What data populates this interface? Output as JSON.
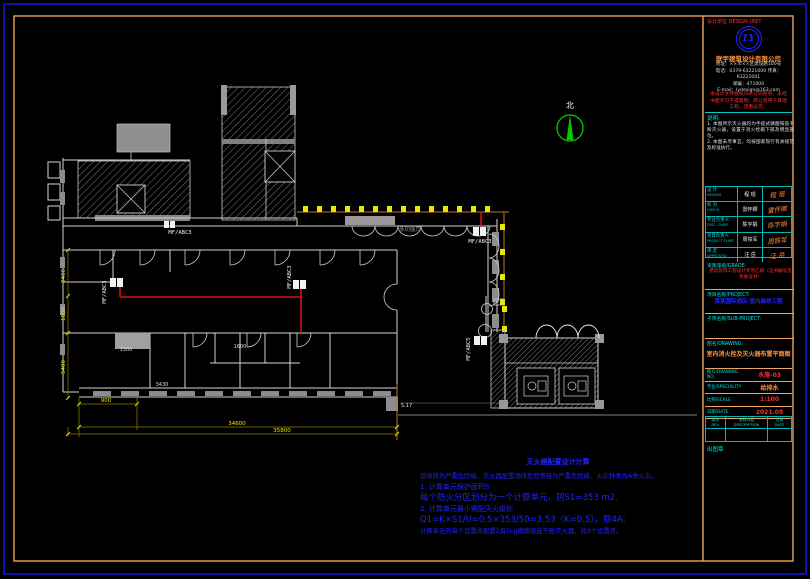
{
  "canvas": {
    "width": 810,
    "height": 579
  },
  "colors": {
    "border_blue": "#1515d8",
    "border_orange": "#eda45f",
    "wall_gray": "#d4d4d4",
    "fill_gray": "#8c8c8c",
    "pipe_red": "#ff1212",
    "axis_orange": "#c07818",
    "dim_yellow": "#e6e600",
    "cyan": "#00e0e0",
    "calc_blue": "#2222ff",
    "north_green": "#00cc00"
  },
  "plan": {
    "north_label": "北",
    "room_label": "多功能厅",
    "extinguishers": [
      {
        "label": "MF/ABC3"
      },
      {
        "label": "MF/ABC3"
      },
      {
        "label": "MF/ABC3"
      },
      {
        "label": "MF/ABC5"
      },
      {
        "label": "MF/ABC3"
      }
    ],
    "dims": {
      "bottom_small": "900",
      "bottom_mid": "34600",
      "bottom_total": "35800",
      "inner_a": "3430",
      "inner_b": "1500",
      "inner_c": "1600",
      "level": "5.17",
      "left_a": "2400",
      "left_b": "1800",
      "left_c": "5400"
    }
  },
  "calc": {
    "title": "灭火器配置设计计算",
    "lines": [
      "该场所为严重危险级，灭火器配置场所危险等级为严重危险级，火灾种类为A类火灾。",
      "1. 计算单元保护面积S",
      "每个防火分区划分为一个计算单元，则S1=353 m2.",
      "2. 计算单元最小需配灭火级别",
      "Q1=K×S1/U=0.5×353/50=3.53（K=0.5），取4A;",
      "计算单元内每个设置点配置2具5kg磷酸铵盐干粉灭火器，共3个设置点。"
    ]
  },
  "title_block": {
    "design_unit_label": "设计单位 DESIGN UNIT",
    "logo_text": "LY",
    "company": "联宇建筑设计有限公司",
    "address_lines": [
      "地址：××市××区建设路100号",
      "电话：0379-63221000 传真：63221001",
      "邮编：471000",
      "E-mail：lydesign@163.com"
    ],
    "copyright_lines": [
      "本设计文件版权归本公司所有，未经",
      "书面许可不得复制、转让或用于其他",
      "工程，违者必究。"
    ],
    "notes_label": "说明:",
    "notes": [
      "1. 本图所示灭火器均为手提式磷酸铵盐干粉灭火器，设置于消火栓箱下部及明显部位。",
      "2. 本图未尽事宜，均按国家现行有关规范及标准执行。"
    ],
    "staff_rows": [
      {
        "role": "设 计",
        "role_en": "DESIGN",
        "name": "程 琨",
        "signature": "程 琨"
      },
      {
        "role": "校 对",
        "role_en": "CHECK",
        "name": "雷怀卿",
        "signature": "雷怀卿"
      },
      {
        "role": "专业负责人",
        "role_en": "DISC. CHIEF",
        "name": "陈宇娟",
        "signature": "陈宇娟"
      },
      {
        "role": "项目负责人",
        "role_en": "PROJECT CHIEF",
        "name": "周铁军",
        "signature": "周铁军"
      },
      {
        "role": "审 定",
        "role_en": "APPROVED",
        "name": "汪 岳",
        "signature": "汪 岳"
      }
    ],
    "grade_label": "资质等级/GRADE:",
    "grade_value": "建筑装饰工程设计专项乙级（证书编号见资质证书）",
    "project_label": "项目名称/PROJECT:",
    "project_name": "某某国际酒店·室内装修工程",
    "subproject_label": "子项名称/SUB-PROJECT:",
    "drawing_label": "图名/DRAWING:",
    "drawing_title": "室内消火栓及灭火器布置平面图",
    "fields": [
      {
        "label": "图号/DRAWING NO.",
        "value": "水施-03"
      },
      {
        "label": "专业/SPECIALITY",
        "value": "给排水"
      },
      {
        "label": "比例/SCALE",
        "value": "1:100"
      },
      {
        "label": "日期/DATE",
        "value": "2021.08"
      }
    ],
    "rev_headers": [
      {
        "zh": "版次",
        "en": "REV."
      },
      {
        "zh": "修改内容",
        "en": "DESCRIPTION"
      },
      {
        "zh": "日期",
        "en": "DATE"
      }
    ],
    "seal_label": "出图章"
  }
}
